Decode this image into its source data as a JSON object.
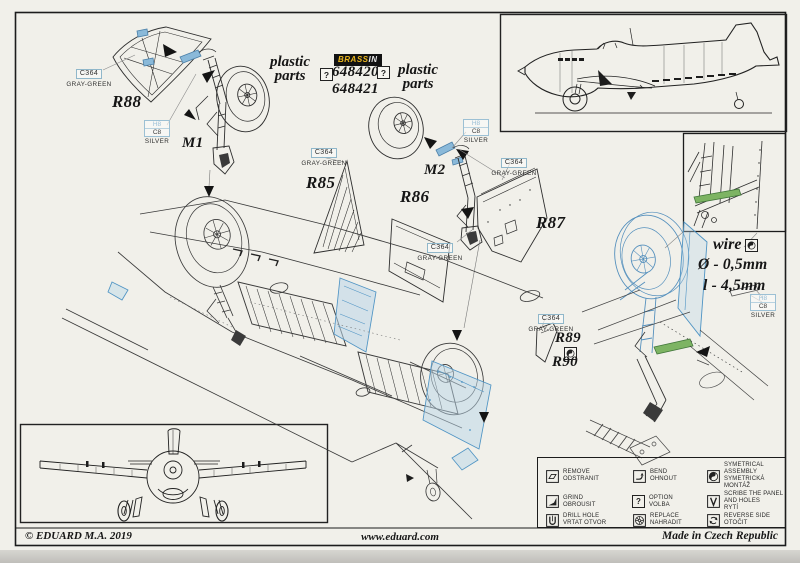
{
  "colors": {
    "brassin_yellow": "#eab61e",
    "resin_blue": "#4f94c4",
    "wire_green": "#6fae58",
    "paper": "#f1f0ea"
  },
  "brand": {
    "logo_brass": "BRASS",
    "logo_in": "IN",
    "number_top": "648420",
    "number_bottom": "648421",
    "plastic_line1": "plastic",
    "plastic_line2": "parts",
    "option_mark": "?"
  },
  "paints": {
    "c364": {
      "code": "C364",
      "name": "GRAY-GREEN"
    },
    "silver": {
      "h": "H8",
      "c": "C8",
      "name": "SILVER"
    }
  },
  "parts": {
    "r88": "R88",
    "m1": "M1",
    "r85": "R85",
    "r86": "R86",
    "m2": "M2",
    "r87": "R87",
    "r89": "R89",
    "r90": "R90"
  },
  "wire": {
    "label": "wire",
    "diameter": "Ø - 0,5mm",
    "length": "l - 4,5mm"
  },
  "legend": {
    "items": [
      {
        "id": "remove",
        "en": "REMOVE",
        "cz": "ODSTRANIT"
      },
      {
        "id": "bend",
        "en": "BEND",
        "cz": "OHNOUT"
      },
      {
        "id": "symmetrical-assembly",
        "en": "SYMETRICAL ASSEMBLY",
        "cz": "SYMETRICKÁ MONTÁŽ"
      },
      {
        "id": "grind",
        "en": "GRIND",
        "cz": "OBROUSIT"
      },
      {
        "id": "option",
        "en": "OPTION",
        "cz": "VOLBA",
        "glyph": "?"
      },
      {
        "id": "scribe",
        "en": "SCRIBE THE PANEL AND HOLES",
        "cz": "RYTÍ"
      },
      {
        "id": "drill",
        "en": "DRILL HOLE",
        "cz": "VRTAT OTVOR"
      },
      {
        "id": "replace",
        "en": "REPLACE",
        "cz": "NAHRADIT"
      },
      {
        "id": "reverse",
        "en": "REVERSE SIDE",
        "cz": "OTOČIT"
      }
    ]
  },
  "footer": {
    "copyright": "© EDUARD  M.A. 2019",
    "website": "www.eduard.com",
    "origin": "Made in Czech Republic"
  }
}
